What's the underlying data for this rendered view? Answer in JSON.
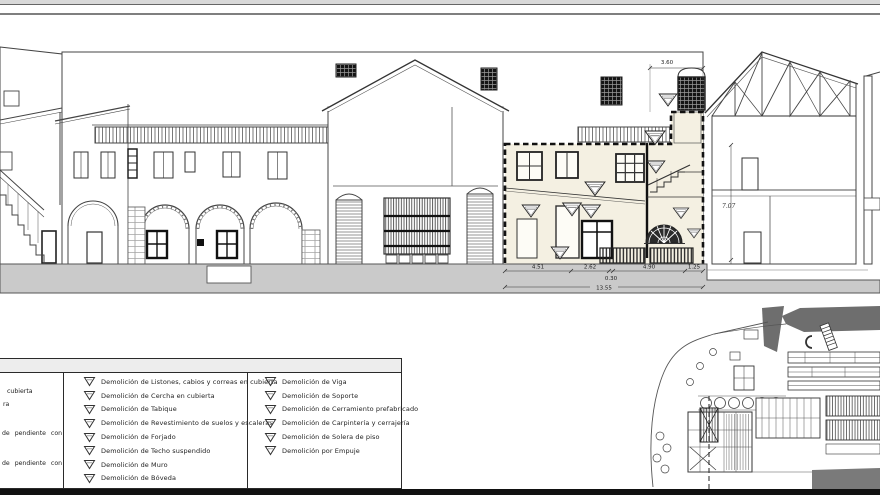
{
  "legend": {
    "col1_fragments": [
      "cubierta",
      "ra",
      "",
      "de pendiente con",
      "de pendiente con"
    ],
    "col2": [
      "Demolición de Listones, cabios y correas en cubierta",
      "Demolición de Cercha en cubierta",
      "Demolición de Tabique",
      "Demolición de Revestimiento de suelos y escaleras",
      "Demolición de Forjado",
      "Demolición de Techo suspendido",
      "Demolición de Muro",
      "Demolición de Bóveda"
    ],
    "col3": [
      "Demolición de Viga",
      "Demolición de Soporte",
      "Demolición de Cerramiento prefabricado",
      "Demolición de Carpintería y cerrajería",
      "Demolición de Solera de piso",
      "Demolición por Empuje"
    ]
  },
  "dims": {
    "tower_width": "3.60",
    "section_height": "7.07",
    "seg1": "4.51",
    "seg2": "2.62",
    "seg3": "0.30",
    "seg4": "4.90",
    "seg5": "1.25",
    "total": "13.55"
  },
  "marker": {
    "shape": "inverted-triangle"
  },
  "colors": {
    "demolition_zone_fill": "#f4f0e2",
    "ground": "#cacaca",
    "siteplan_dark": "#6e6e6e",
    "line": "#3a3a3a"
  }
}
